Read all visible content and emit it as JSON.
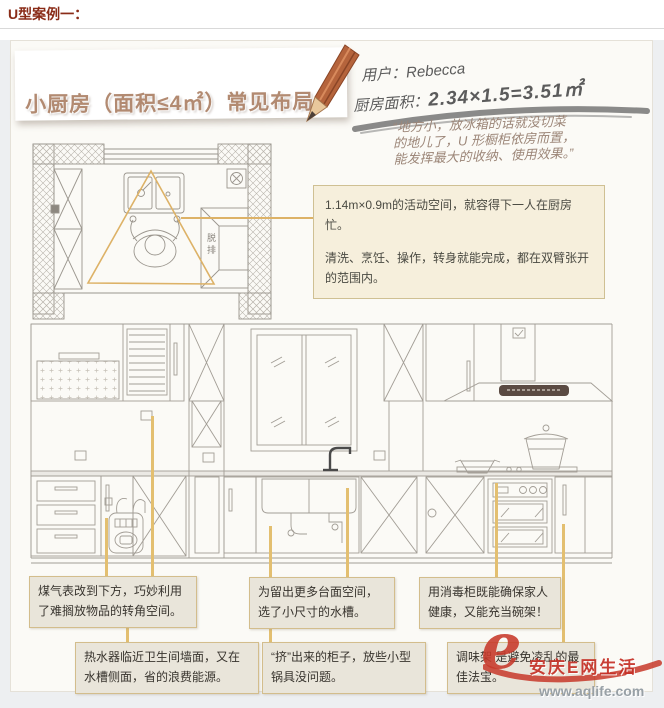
{
  "page": {
    "heading": "U型案例一："
  },
  "banner": {
    "title": "小厨房（面积≤4㎡）常见布局"
  },
  "handwriting": {
    "user": "用户：Rebecca",
    "area_label": "厨房面积：",
    "area_value": "2.34×1.5=3.51㎡"
  },
  "quote": {
    "line1": "“地方小，放冰箱的话就没切菜",
    "line2": "的地儿了，U 形橱柜依房而置，",
    "line3": "能发挥最大的收纳、使用效果。”"
  },
  "plan": {
    "appliance_label": "脱排"
  },
  "info_box": {
    "para1": "1.14m×0.9m的活动空间，就容得下一人在厨房忙。",
    "para2": "清洗、烹饪、操作，转身就能完成，都在双臂张开的范围内。"
  },
  "callouts": [
    "煤气表改到下方，巧妙利用了难搁放物品的转角空间。",
    "热水器临近卫生间墙面，又在水槽侧面，省的浪费能源。",
    "为留出更多台面空间，选了小尺寸的水槽。",
    "“挤”出来的柜子，放些小型锅具没问题。",
    "用消毒柜既能确保家人健康，又能充当碗架！",
    "调味架 是避免凌乱的最佳法宝。"
  ],
  "watermark": {
    "logo_letter": "e",
    "site_name": "安庆E网生活",
    "url": "www.aqlife.com"
  },
  "colors": {
    "heading_red": "#8a2c18",
    "title_brown": "#b28a71",
    "accent_tan": "#ddb267",
    "callout_bg": "#e9e5da",
    "callout_border": "#d3bd8c",
    "info_bg": "#f6efdc",
    "watermark_red": "#c53026"
  }
}
